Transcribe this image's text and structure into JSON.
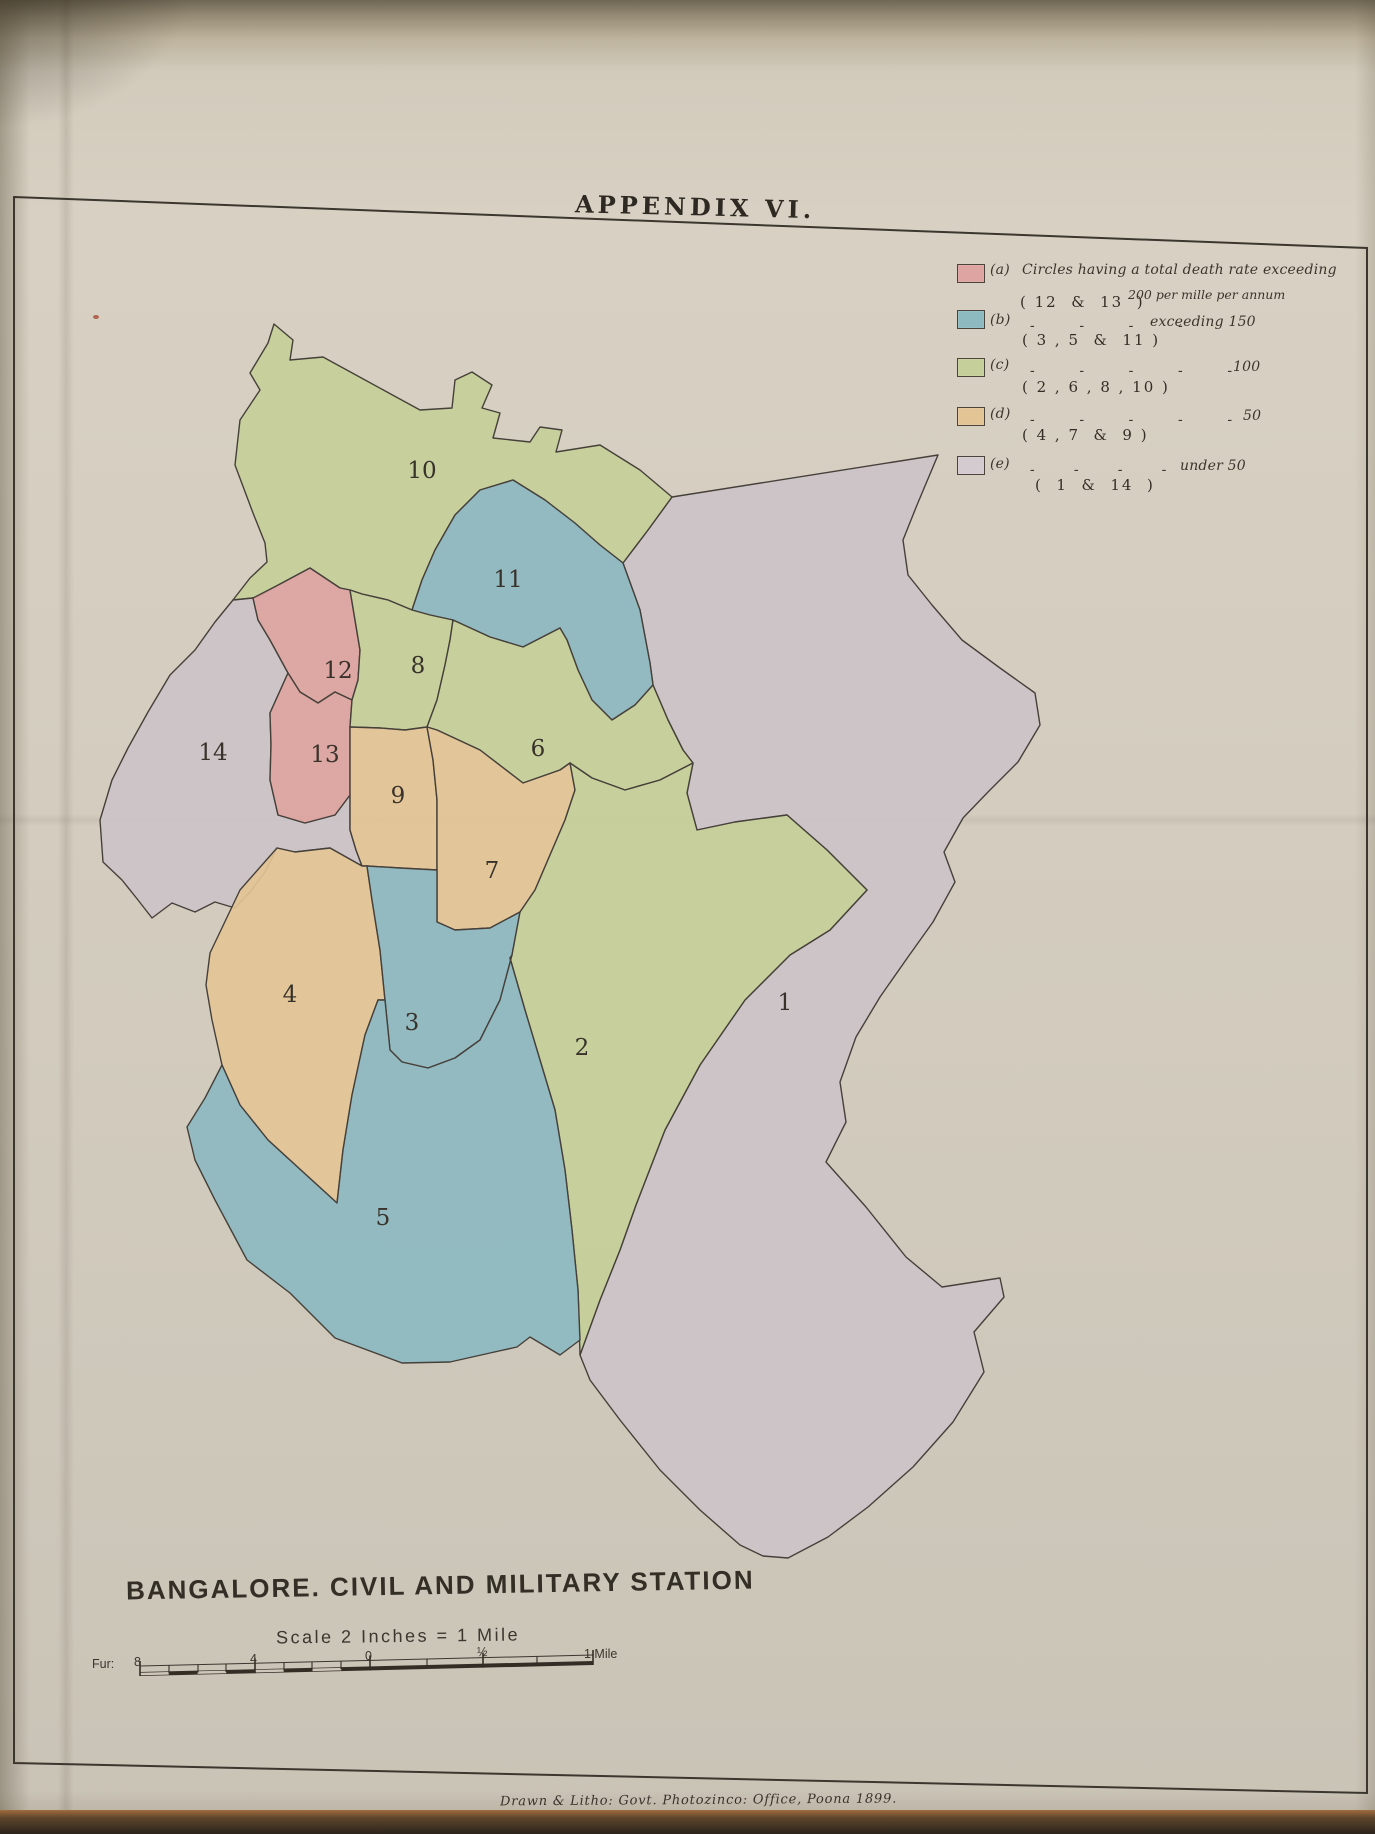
{
  "page": {
    "title": "APPENDIX VI.",
    "map_title": "BANGALORE. CIVIL AND MILITARY STATION",
    "scale_caption": "Scale 2 Inches = 1 Mile",
    "attribution": "Drawn & Litho: Govt. Photozinco: Office, Poona 1899."
  },
  "legend": {
    "title_note": "death-rate categories, per mille per annum",
    "entries": [
      {
        "key": "(a)",
        "category": "a",
        "color": "#dda4a1",
        "text": "Circles having a total death rate exceeding",
        "text2": "200 per mille per annum",
        "value": "",
        "ditto": "",
        "circles": "( 12  &  13  )",
        "sy": 264,
        "ky": 262,
        "ty": 262,
        "t2x": 1128,
        "t2y": 287,
        "vx": 0,
        "vy": 0,
        "dy": 0,
        "cx": 1020,
        "cy": 293
      },
      {
        "key": "(b)",
        "category": "b",
        "color": "#8db9c1",
        "text": "",
        "text2": "",
        "value": "exceeding 150",
        "ditto": "-        -        -        -",
        "circles": "( 3 , 5  &  11 )",
        "sy": 310,
        "ky": 312,
        "ty": 0,
        "t2x": 0,
        "t2y": 0,
        "vx": 1150,
        "vy": 314,
        "dy": 318,
        "cx": 1022,
        "cy": 331
      },
      {
        "key": "(c)",
        "category": "c",
        "color": "#c5cf99",
        "text": "",
        "text2": "",
        "value": "100",
        "ditto": "-        -        -        -        -",
        "circles": "( 2 , 6 , 8 , 10 )",
        "sy": 358,
        "ky": 357,
        "ty": 0,
        "t2x": 0,
        "t2y": 0,
        "vx": 1233,
        "vy": 359,
        "dy": 363,
        "cx": 1022,
        "cy": 378
      },
      {
        "key": "(d)",
        "category": "d",
        "color": "#e3c495",
        "text": "",
        "text2": "",
        "value": "50",
        "ditto": "-        -        -        -        -",
        "circles": "( 4 , 7  &  9 )",
        "sy": 407,
        "ky": 406,
        "ty": 0,
        "t2x": 0,
        "t2y": 0,
        "vx": 1243,
        "vy": 408,
        "dy": 412,
        "cx": 1022,
        "cy": 426
      },
      {
        "key": "(e)",
        "category": "e",
        "color": "#d4cbd0",
        "text": "",
        "text2": "",
        "value": "under 50",
        "ditto": "-       -       -       -",
        "circles": "(  1  &  14  )",
        "sy": 456,
        "ky": 456,
        "ty": 0,
        "t2x": 0,
        "t2y": 0,
        "vx": 1180,
        "vy": 458,
        "dy": 462,
        "cx": 1035,
        "cy": 476
      }
    ]
  },
  "map": {
    "palette": {
      "a": "#dda4a1",
      "b": "#8db9c1",
      "c": "#c5cf99",
      "d": "#e3c495",
      "e": "#ccc3c8"
    },
    "stroke": "#46403a",
    "border_points": "14,197 1367,248 1367,1793 14,1763",
    "regions": [
      {
        "number": "1",
        "category": "e",
        "lx": 785,
        "ly": 1010,
        "path": "M672,497 L938,455 L917,505 L903,540 L908,575 L932,605 L962,640 L1000,668 L1035,693 L1040,725 L1018,762 L988,792 L963,818 L944,852 L955,882 L933,922 L908,957 L880,997 L856,1037 L840,1082 L846,1122 L826,1162 L866,1207 L906,1257 L942,1287 L1000,1278 L1004,1297 L974,1332 L984,1372 L953,1422 L913,1467 L868,1507 L828,1537 L788,1558 L763,1556 L740,1545 L700,1510 L660,1470 L620,1420 L590,1380 L580,1355 L600,1300 L620,1250 L636,1205 L665,1130 L700,1065 L745,1000 L790,955 L830,930 L867,890 L827,850 L787,815 L735,822 L697,830 L687,793 L693,763 L683,750 L668,720 L653,685 L650,663 L640,610 L623,563 L648,530 Z"
      },
      {
        "number": "10",
        "category": "c",
        "lx": 422,
        "ly": 478,
        "path": "M274,324 L293,340 L290,360 L323,357 L398,398 L420,410 L452,408 L455,380 L472,372 L492,385 L482,408 L500,413 L493,438 L530,442 L540,427 L562,430 L556,452 L600,445 L640,470 L672,497 L648,530 L623,563 L600,545 L570,520 L545,500 L513,480 L480,490 L455,515 L435,550 L422,580 L412,610 L388,600 L362,594 L350,590 L340,588 L310,568 L282,583 L258,597 L253,598 L233,600 L250,578 L267,562 L265,543 L253,513 L235,465 L240,420 L260,390 L250,373 L268,343 Z"
      },
      {
        "number": "11",
        "category": "b",
        "lx": 508,
        "ly": 587,
        "path": "M412,610 L422,580 L435,550 L455,515 L480,490 L513,480 L545,500 L575,523 L600,545 L623,563 L640,610 L650,663 L653,685 L635,705 L612,720 L592,700 L578,670 L567,640 L560,628 L523,647 L490,637 L453,620 L430,615 Z"
      },
      {
        "number": "14",
        "category": "e",
        "lx": 213,
        "ly": 760,
        "path": "M233,600 L253,598 L258,620 L270,640 L288,673 L270,713 L271,745 L270,780 L278,815 L305,823 L335,815 L350,795 L350,830 L356,850 L362,866 L330,848 L295,852 L277,848 L265,872 L250,892 L235,908 L215,902 L195,912 L172,903 L152,918 L138,900 L122,880 L103,862 L100,820 L112,780 L128,748 L148,712 L170,675 L195,650 L215,622 Z"
      },
      {
        "number": "12",
        "category": "a",
        "lx": 338,
        "ly": 678,
        "path": "M253,598 L282,583 L310,568 L340,588 L350,590 L355,620 L360,650 L358,680 L352,700 L335,692 L318,703 L300,692 L288,673 L270,640 L258,620 Z"
      },
      {
        "number": "13",
        "category": "a",
        "lx": 325,
        "ly": 762,
        "path": "M288,673 L300,692 L318,703 L335,692 L352,700 L350,727 L350,760 L350,795 L335,815 L305,823 L278,815 L270,780 L271,745 L270,713 Z"
      },
      {
        "number": "8",
        "category": "c",
        "lx": 418,
        "ly": 673,
        "path": "M350,590 L362,594 L388,600 L412,610 L430,615 L453,620 L450,640 L445,665 L437,700 L427,727 L405,730 L380,728 L350,727 L352,700 L358,680 L360,650 L355,620 Z"
      },
      {
        "number": "6",
        "category": "c",
        "lx": 538,
        "ly": 756,
        "path": "M453,620 L490,637 L523,647 L560,628 L567,640 L578,670 L592,700 L612,720 L635,705 L653,685 L668,720 L683,750 L693,763 L660,780 L625,790 L592,778 L570,763 L560,770 L523,783 L480,750 L437,730 L427,727 L437,700 L445,665 L450,640 Z"
      },
      {
        "number": "9",
        "category": "d",
        "lx": 398,
        "ly": 803,
        "path": "M350,727 L380,728 L405,730 L427,727 L433,760 L437,800 L437,835 L437,870 L400,868 L367,866 L362,866 L356,850 L350,830 L350,795 L350,760 Z"
      },
      {
        "number": "7",
        "category": "d",
        "lx": 492,
        "ly": 878,
        "path": "M427,727 L437,730 L480,750 L523,783 L560,770 L570,763 L575,790 L565,820 L550,855 L535,890 L520,912 L490,928 L455,930 L437,922 L437,870 L437,835 L437,800 L433,760 Z"
      },
      {
        "number": "4",
        "category": "d",
        "lx": 290,
        "ly": 1002,
        "path": "M210,953 L240,890 L277,848 L295,852 L330,848 L362,866 L367,866 L372,900 L380,950 L385,1000 L378,1000 L365,1035 L352,1095 L343,1150 L337,1203 L303,1172 L268,1140 L240,1105 L222,1065 L212,1020 L206,985 Z"
      },
      {
        "number": "3",
        "category": "b",
        "lx": 412,
        "ly": 1030,
        "path": "M437,870 L437,922 L455,930 L490,928 L520,912 L512,955 L500,1000 L480,1040 L455,1058 L428,1068 L402,1062 L390,1050 L385,1000 L380,950 L372,900 L367,866 L400,868 Z"
      },
      {
        "number": "2",
        "category": "c",
        "lx": 582,
        "ly": 1055,
        "path": "M570,763 L592,778 L625,790 L660,780 L693,763 L687,793 L697,830 L735,822 L787,815 L827,850 L867,890 L830,930 L790,955 L745,1000 L700,1065 L665,1130 L636,1205 L620,1250 L600,1300 L580,1355 L578,1290 L572,1230 L565,1170 L555,1110 L540,1060 L525,1010 L510,958 L512,955 L520,912 L535,890 L550,855 L565,820 L575,790 Z"
      },
      {
        "number": "5",
        "category": "b",
        "lx": 383,
        "ly": 1225,
        "path": "M187,1127 L205,1098 L222,1065 L240,1105 L268,1140 L303,1172 L337,1203 L343,1150 L352,1095 L365,1035 L378,1000 L385,1000 L390,1050 L402,1062 L428,1068 L455,1058 L480,1040 L500,1000 L512,955 L510,958 L525,1010 L540,1060 L555,1110 L565,1170 L572,1230 L578,1290 L580,1340 L560,1355 L530,1337 L517,1347 L490,1353 L450,1362 L402,1363 L335,1338 L290,1293 L247,1260 L215,1200 L195,1160 Z"
      }
    ]
  },
  "scale_bar": {
    "bar": {
      "x1": 140,
      "y1": 1674,
      "x2": 593,
      "y2": 1663
    },
    "major_ticks": [
      140,
      255,
      370,
      483,
      593
    ],
    "minor_ticks": [
      169,
      198,
      226,
      284,
      312,
      341,
      427,
      537
    ],
    "labels": [
      {
        "t": "Fur:",
        "x": 92,
        "y": 1668
      },
      {
        "t": "8",
        "x": 134,
        "y": 1666
      },
      {
        "t": "4",
        "x": 250,
        "y": 1663
      },
      {
        "t": "0",
        "x": 365,
        "y": 1660
      },
      {
        "t": "½",
        "x": 477,
        "y": 1656
      },
      {
        "t": "1 Mile",
        "x": 584,
        "y": 1658
      }
    ]
  }
}
